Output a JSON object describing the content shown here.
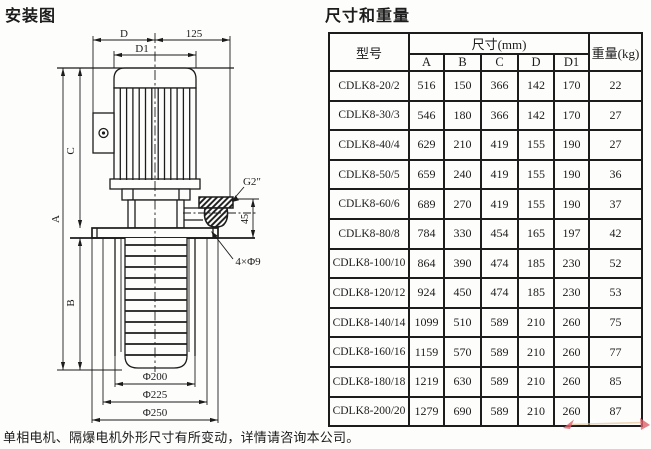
{
  "colors": {
    "ink": "#1c1c1c",
    "wm_red": "#e0606a",
    "wm_line": "#e8c9a0"
  },
  "page": {
    "left_title": "安装图",
    "right_title": "尺寸和重量",
    "footer_note": "单相电机、隔爆电机外形尺寸有所变动，详情请咨询本公司。"
  },
  "drawing": {
    "labels": {
      "dim_d": "D",
      "dim_125": "125",
      "dim_d1": "D1",
      "dim_a": "A",
      "dim_b": "B",
      "dim_c": "C",
      "dim_45": "45",
      "port_thread": "G2″",
      "mounting_holes": "4×Φ9",
      "dia_200": "Φ200",
      "dia_225": "Φ225",
      "dia_250": "Φ250"
    }
  },
  "table": {
    "header": {
      "model": "型号",
      "dims_group": "尺寸(mm)",
      "dim_cols": [
        "A",
        "B",
        "C",
        "D",
        "D1"
      ],
      "weight": "重量(kg)"
    },
    "rows": [
      {
        "model": "CDLK8-20/2",
        "a": 516,
        "b": 150,
        "c": 366,
        "d": 142,
        "d1": 170,
        "kg": 22
      },
      {
        "model": "CDLK8-30/3",
        "a": 546,
        "b": 180,
        "c": 366,
        "d": 142,
        "d1": 170,
        "kg": 27
      },
      {
        "model": "CDLK8-40/4",
        "a": 629,
        "b": 210,
        "c": 419,
        "d": 155,
        "d1": 190,
        "kg": 27
      },
      {
        "model": "CDLK8-50/5",
        "a": 659,
        "b": 240,
        "c": 419,
        "d": 155,
        "d1": 190,
        "kg": 36
      },
      {
        "model": "CDLK8-60/6",
        "a": 689,
        "b": 270,
        "c": 419,
        "d": 155,
        "d1": 190,
        "kg": 37
      },
      {
        "model": "CDLK8-80/8",
        "a": 784,
        "b": 330,
        "c": 454,
        "d": 165,
        "d1": 197,
        "kg": 42
      },
      {
        "model": "CDLK8-100/10",
        "a": 864,
        "b": 390,
        "c": 474,
        "d": 185,
        "d1": 230,
        "kg": 52
      },
      {
        "model": "CDLK8-120/12",
        "a": 924,
        "b": 450,
        "c": 474,
        "d": 185,
        "d1": 230,
        "kg": 53
      },
      {
        "model": "CDLK8-140/14",
        "a": 1099,
        "b": 510,
        "c": 589,
        "d": 210,
        "d1": 260,
        "kg": 75
      },
      {
        "model": "CDLK8-160/16",
        "a": 1159,
        "b": 570,
        "c": 589,
        "d": 210,
        "d1": 260,
        "kg": 77
      },
      {
        "model": "CDLK8-180/18",
        "a": 1219,
        "b": 630,
        "c": 589,
        "d": 210,
        "d1": 260,
        "kg": 85
      },
      {
        "model": "CDLK8-200/20",
        "a": 1279,
        "b": 690,
        "c": 589,
        "d": 210,
        "d1": 260,
        "kg": 87
      }
    ]
  }
}
